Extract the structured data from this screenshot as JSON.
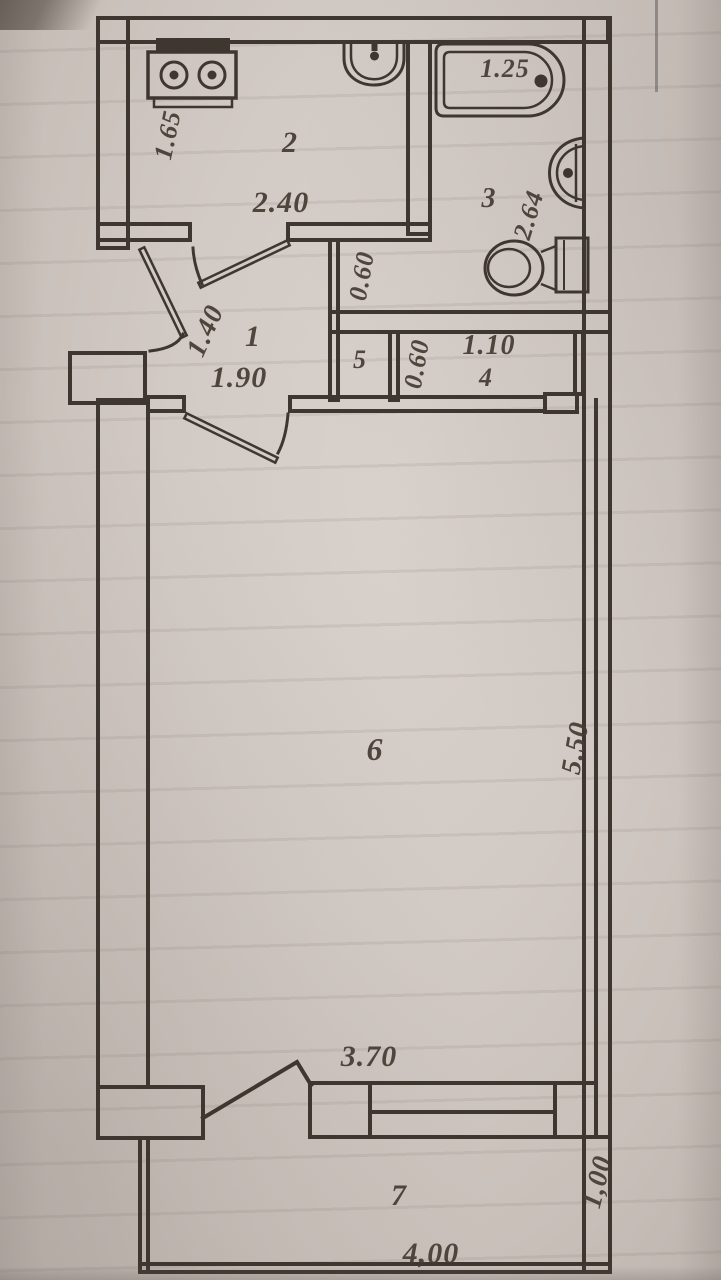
{
  "document": {
    "kind": "scanned apartment floor plan",
    "ink_color": "#3e372f",
    "paper_color": "#d2cac4"
  },
  "plan": {
    "labels": {
      "room2_number": "2",
      "room2_width": "2.40",
      "room2_height": "1.65",
      "room3_number": "3",
      "room3_height": "2.64",
      "bathtub_length": "1.25",
      "room1_number": "1",
      "room1_width": "1.90",
      "room1_depth": "1.40",
      "passage_width": "0.60",
      "room5_number": "5",
      "room5_width": "0.60",
      "room4_number": "4",
      "room4_width": "1.10",
      "room6_number": "6",
      "room6_width": "3.70",
      "room6_height": "5.50",
      "room7_number": "7",
      "room7_width": "4,00",
      "room7_height": "1,00"
    },
    "fixtures": [
      "stove",
      "kitchen-sink",
      "bathtub",
      "wash-basin",
      "toilet"
    ]
  }
}
